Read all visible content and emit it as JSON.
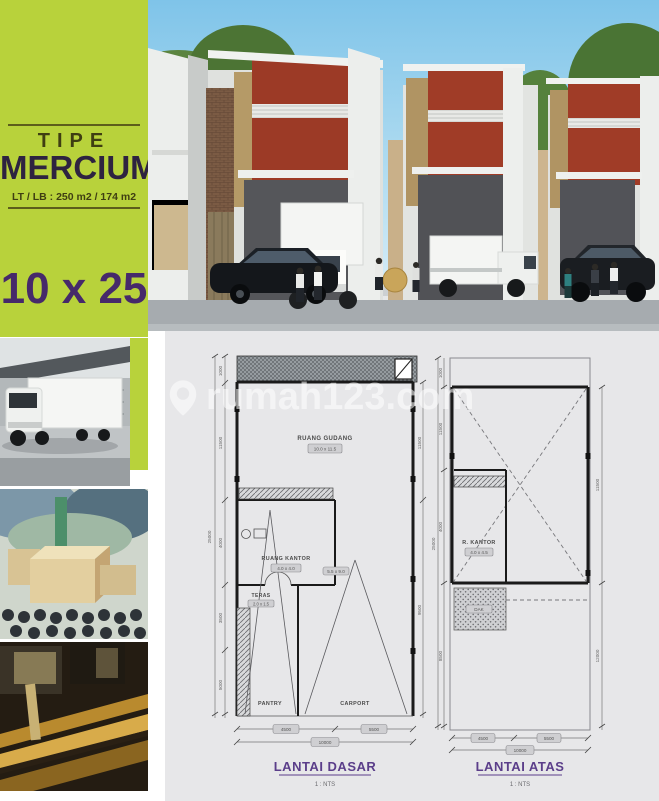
{
  "sidebar": {
    "tipe_label": "TIPE",
    "type_name": "MERCIUM",
    "lt_lb_line": "LT / LB : 250 m2 / 174 m2",
    "lot_size": "10 x 25"
  },
  "watermark": {
    "text": "rumah123.com"
  },
  "plan_dasar": {
    "title": "LANTAI DASAR",
    "scale": "1 : NTS",
    "room_gudang": "RUANG GUDANG",
    "room_gudang_dim": "10.0 x 11.5",
    "room_kantor": "RUANG KANTOR",
    "room_kantor_dim": "4.0 x 4.0",
    "room_teras": "TERAS",
    "room_teras_dim": "2.0 x 1.5",
    "room_pantry": "PANTRY",
    "room_carport": "CARPORT",
    "carport_dim": "5.5 x 9.0",
    "dim_total_height": "25000",
    "dim_seg_1": "1000",
    "dim_seg_2": "11500",
    "dim_seg_3": "4000",
    "dim_seg_4": "3500",
    "dim_seg_5": "5000",
    "dim_right_upper": "11500",
    "dim_right_lower": "9500",
    "dim_bottom_left": "4500",
    "dim_bottom_right": "5500",
    "dim_bottom_total": "10000"
  },
  "plan_atas": {
    "title": "LANTAI ATAS",
    "scale": "1 : NTS",
    "room_kantor": "R. KANTOR",
    "room_kantor_dim": "4.0 x 4.5",
    "room_dak": "DAK",
    "dim_total_height": "25000",
    "dim_seg_1": "1000",
    "dim_seg_2": "11500",
    "dim_seg_3": "4000",
    "dim_seg_4": "8500",
    "dim_right_upper": "11500",
    "dim_right_lower": "12000",
    "dim_bottom_left": "4500",
    "dim_bottom_right": "5500",
    "dim_bottom_total": "10000"
  },
  "colors": {
    "lime": "#b8d23b",
    "purple": "#46296a",
    "dark_olive": "#3f3e12",
    "plan_bg": "#e7e7e9",
    "facade_red": "#9c3a26"
  }
}
